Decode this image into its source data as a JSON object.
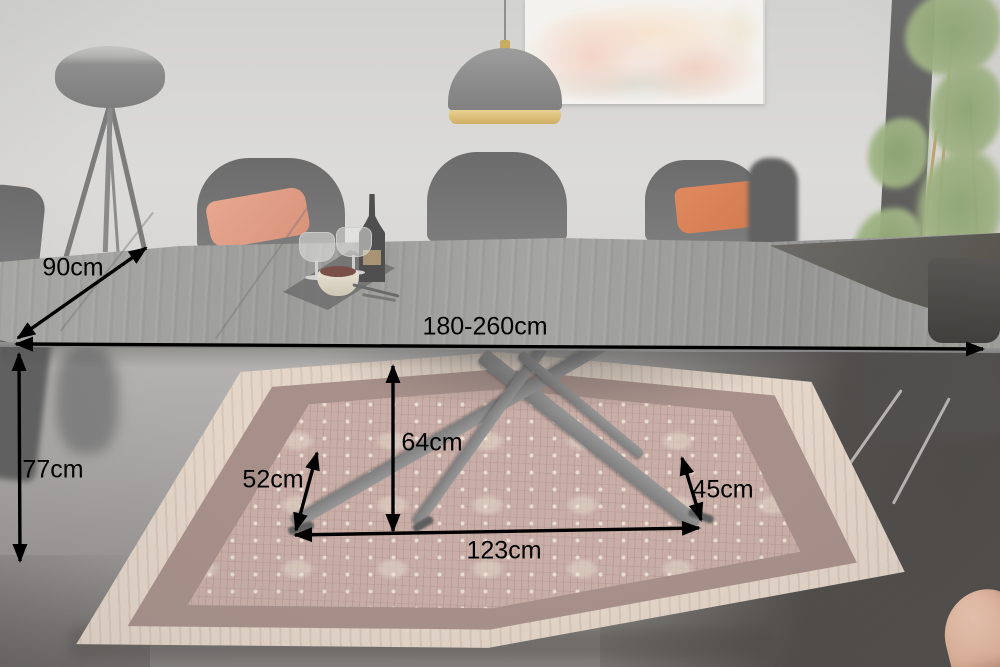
{
  "dimensions": {
    "depth": "90cm",
    "width": "180-260cm",
    "height": "77cm",
    "frame_height": "64cm",
    "frame_left": "52cm",
    "frame_right": "45cm",
    "frame_span": "123cm"
  },
  "colors": {
    "annotation": "#000000",
    "wall": "#d8d8d6",
    "table_top": "#a9a9a7",
    "rug_border": "#e3d5c8",
    "rug_band": "#a8908a",
    "rug_field": "#c8aea7",
    "cushion_salmon": "#e8a78f",
    "cushion_orange": "#e0895f",
    "pendant_gold": "#c9ab64",
    "plant_green": "#8ea673",
    "dark_floor": "#4c4946"
  }
}
